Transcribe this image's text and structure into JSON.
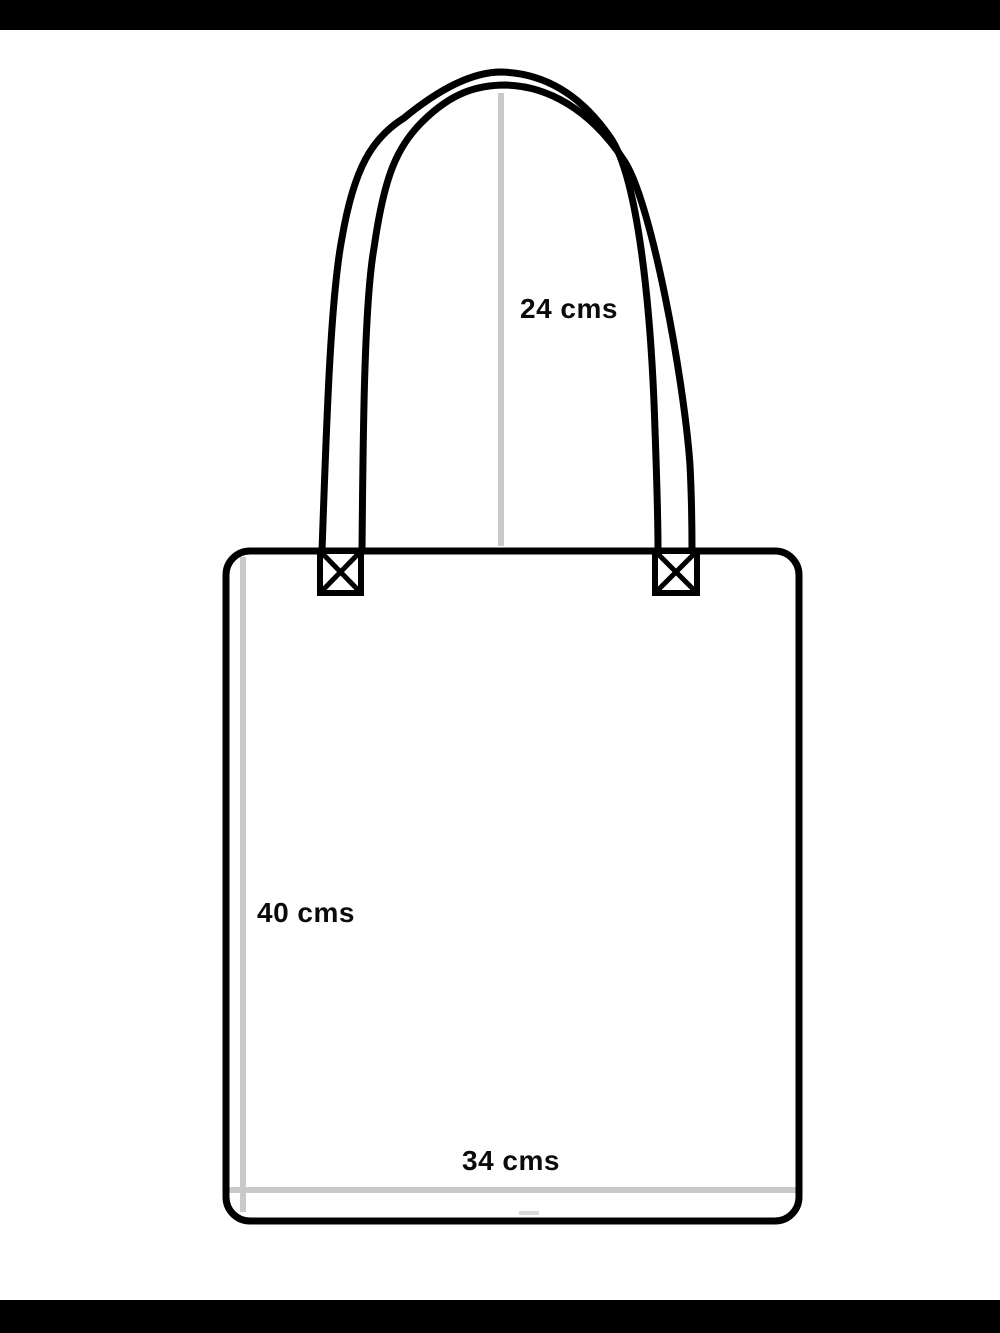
{
  "page": {
    "width_px": 1000,
    "height_px": 1333,
    "background_color": "#ffffff",
    "letterbox_color": "#000000"
  },
  "diagram": {
    "subject": "tote-bag-dimension-diagram",
    "colors": {
      "outline": "#000000",
      "measure_line": "#c9c9c9",
      "center_tick": "#d9d9d9",
      "label_text": "#0b0b0b"
    },
    "measurements": {
      "handle_height": {
        "label": "24 cms"
      },
      "bag_height": {
        "label": "40 cms"
      },
      "bag_width": {
        "label": "34 cms"
      }
    }
  }
}
